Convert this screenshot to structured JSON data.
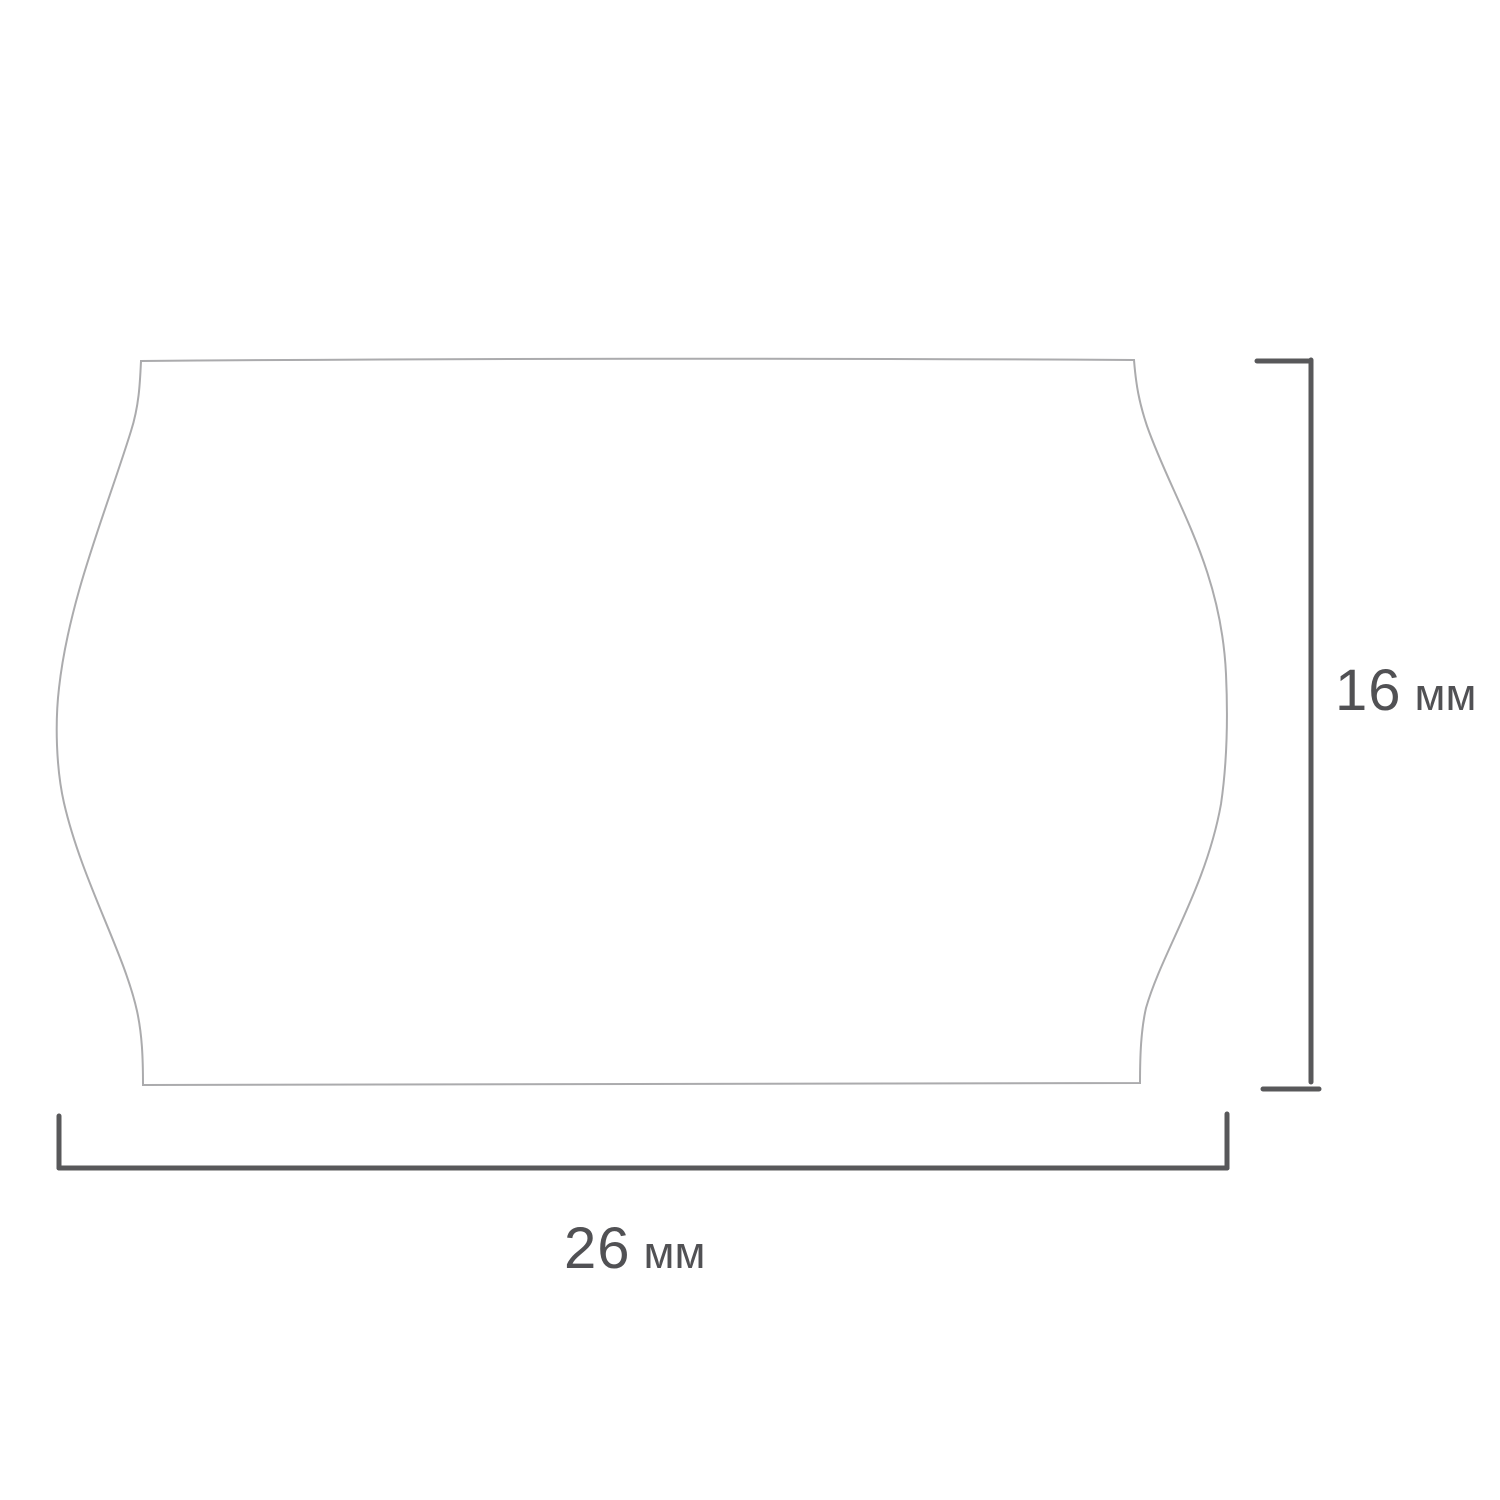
{
  "diagram": {
    "type": "product-dimension-drawing",
    "subject": "wave-edged price label (etiquette) outline",
    "background_color": "#ffffff",
    "outline_color": "#ababad",
    "dimension_line_color": "#58585a",
    "text_color": "#515154",
    "dimensions": {
      "height": {
        "value": "16",
        "unit": "мм",
        "label": "16 мм",
        "side": "right"
      },
      "width": {
        "value": "26",
        "unit": "мм",
        "label": "26 мм",
        "side": "bottom"
      }
    }
  }
}
